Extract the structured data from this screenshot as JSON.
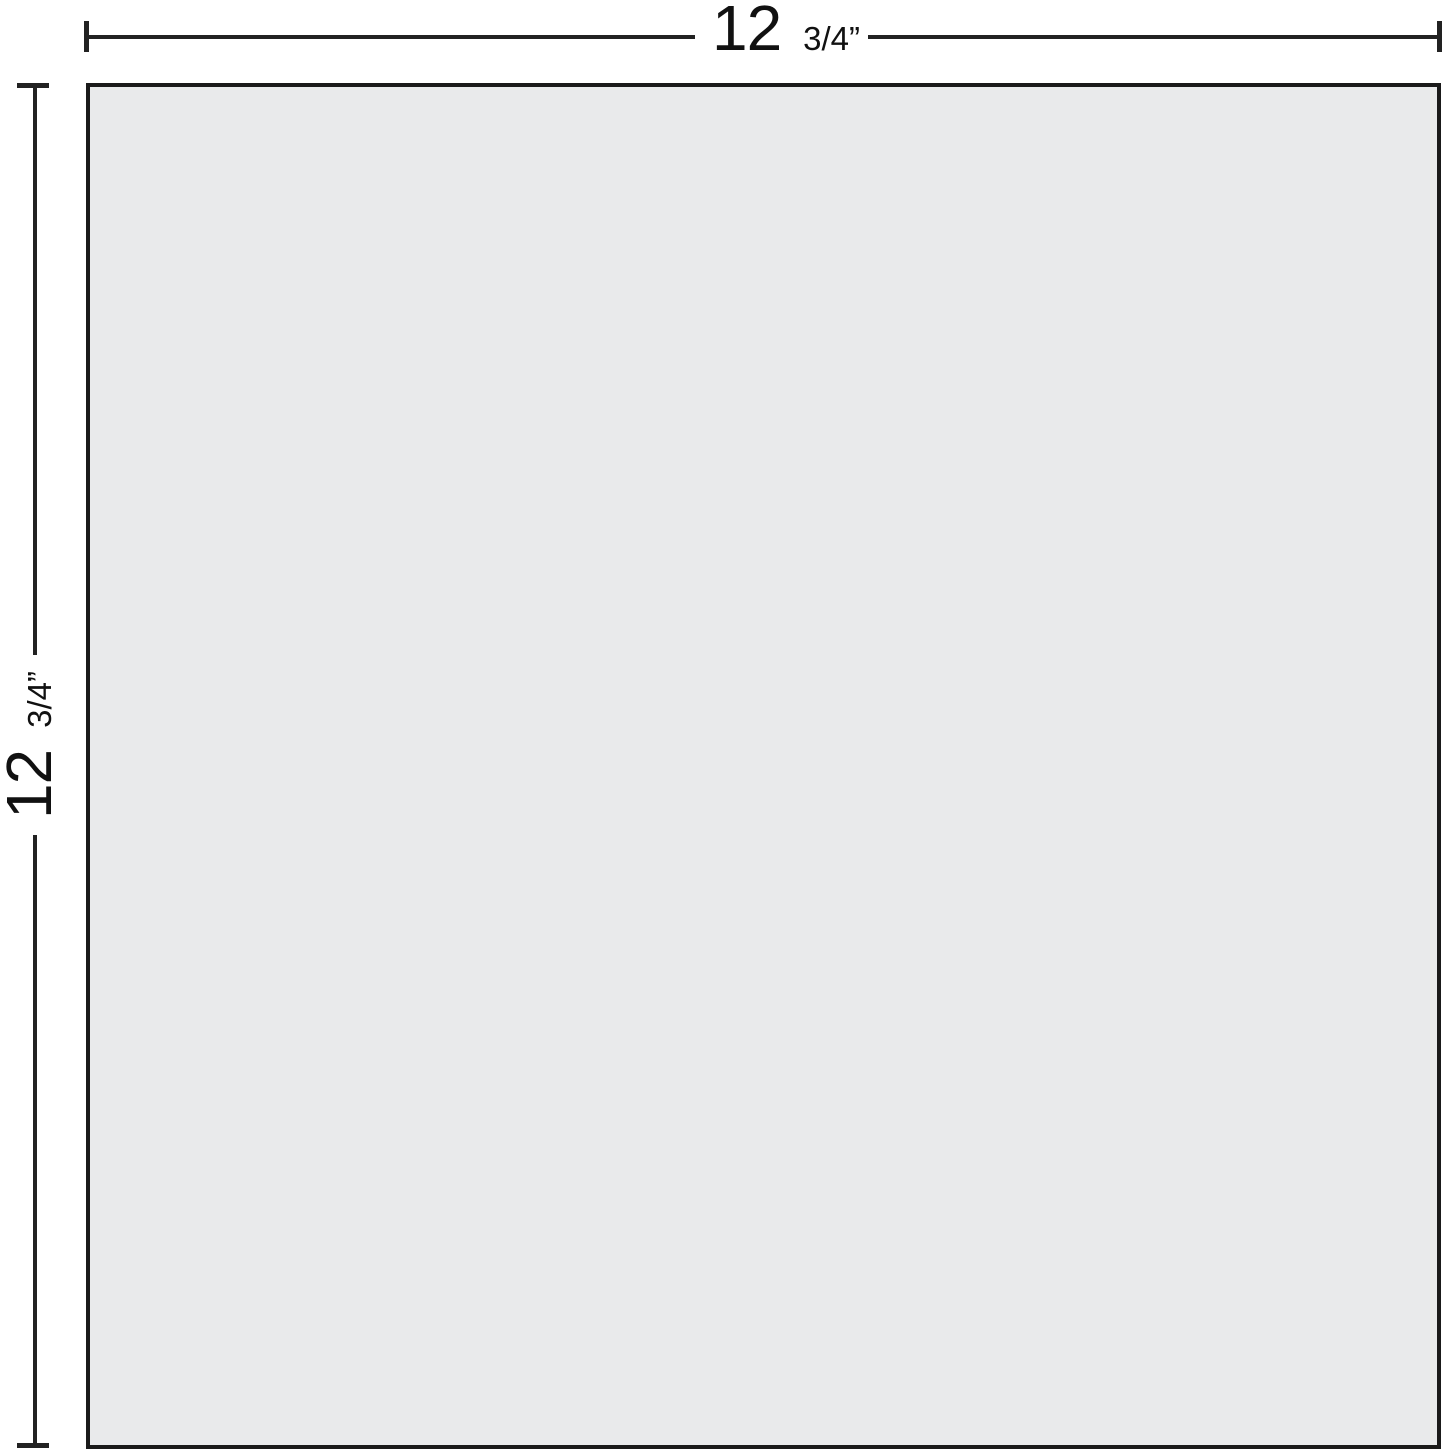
{
  "diagram": {
    "type": "dimension-drawing",
    "panel": {
      "shape": "square",
      "fill_color": "#e9eaeb",
      "border_color": "#1a1a1a",
      "line_color": "#222222"
    },
    "dimensions": {
      "width": {
        "whole": "12",
        "fraction": "3/4”"
      },
      "height": {
        "whole": "12",
        "fraction": "3/4”"
      }
    }
  }
}
